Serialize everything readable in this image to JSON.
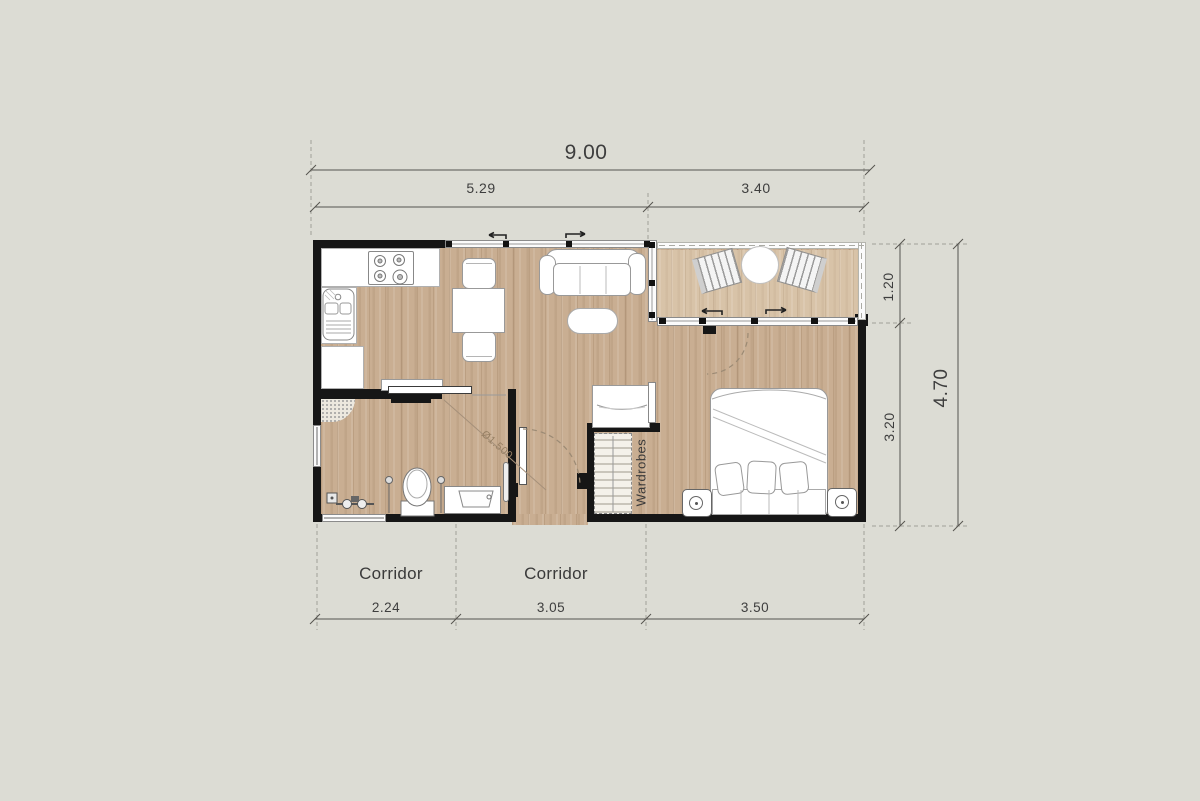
{
  "plan": {
    "type": "apartment-floor-plan",
    "dims": {
      "total_width": "9.00",
      "width_living": "5.29",
      "width_terrace": "3.40",
      "terrace_depth": "1.20",
      "bedroom_depth": "3.20",
      "total_depth": "4.70",
      "bath_width": "2.24",
      "corridor_width": "3.05",
      "bedroom_width": "3.50"
    },
    "labels": {
      "corridor_left": "Corridor",
      "corridor_mid": "Corridor",
      "wardrobes": "Wardrobes",
      "turning_circle": "Ø1.500"
    },
    "colors": {
      "background": "#dcdcd4",
      "wall": "#161616",
      "floor_interior": "#c9ae92",
      "floor_terrace": "#d8c3a8",
      "fixture": "#ffffff",
      "dimension_text": "#3e3e3e"
    },
    "furniture": [
      "stove",
      "kitchen-sink",
      "kitchen-counters",
      "dining-table",
      "dining-chairs",
      "sofa",
      "coffee-table",
      "console",
      "tv",
      "toilet",
      "bathroom-vanity",
      "shower-fittings",
      "entry-door",
      "sliding-doors",
      "desk",
      "wardrobes",
      "bed",
      "pillows",
      "nightstands",
      "bedside-lamps",
      "deck-chairs",
      "terrace-table"
    ]
  }
}
